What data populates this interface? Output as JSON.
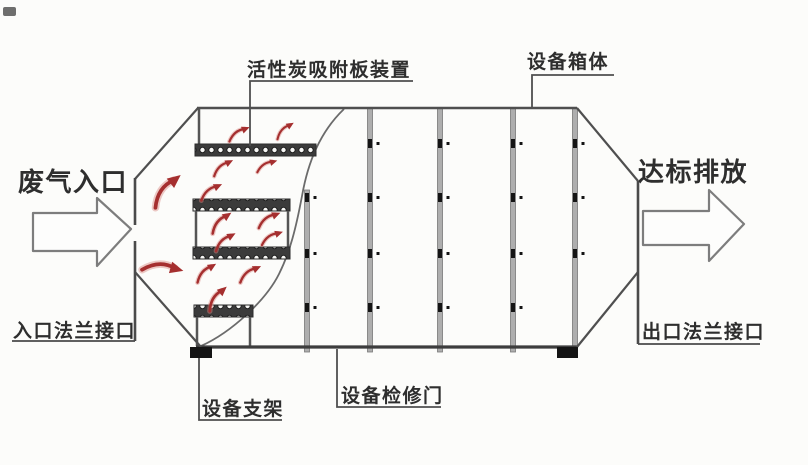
{
  "labels": {
    "carbon_plate_device": "活性炭吸附板装置",
    "equipment_box": "设备箱体",
    "waste_gas_inlet": "废气入口",
    "compliant_discharge": "达标排放",
    "inlet_flange": "入口法兰接口",
    "outlet_flange": "出口法兰接口",
    "equipment_support": "设备支架",
    "maintenance_door": "设备检修门"
  },
  "colors": {
    "line": "#4f4f4f",
    "divider_fill": "#aeaeae",
    "airflow_red": "#a52f2f",
    "foot_black": "#141414",
    "background": "#fcfcfa",
    "text": "#2e2e2e"
  },
  "counts": {
    "panel_dividers": 5,
    "carbon_plates": 4,
    "airflow_arrows": 14
  }
}
